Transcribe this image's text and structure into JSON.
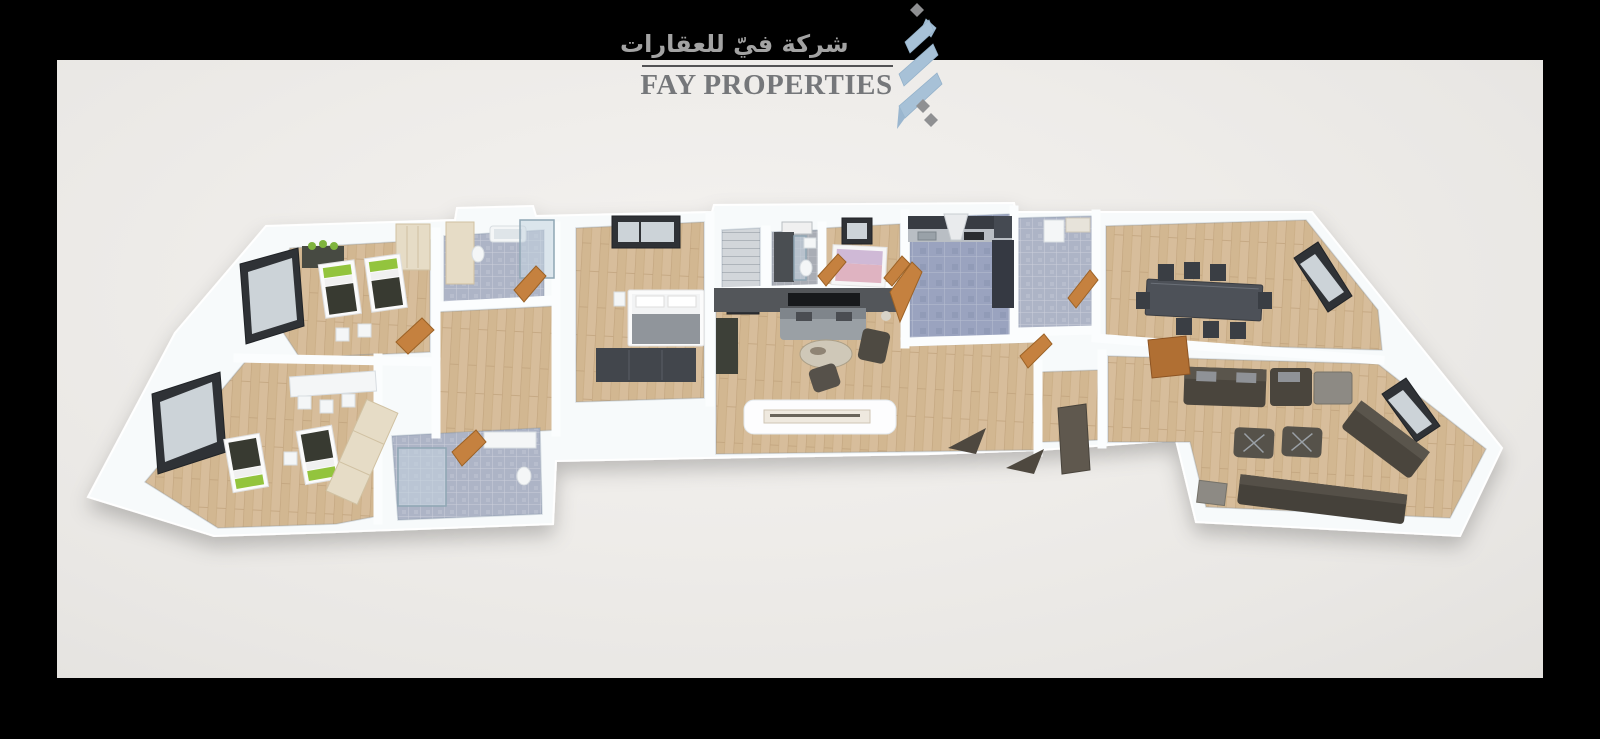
{
  "window": {
    "width": 1600,
    "height": 739
  },
  "brand": {
    "arabic_name": "شركة فيّ للعقارات",
    "english_name": "FAY PROPERTIES"
  },
  "logo": {
    "mark_name": "kufic-calligraphy-monogram",
    "mark_color": "#a7c1d7",
    "diamond_color": "#8f9092",
    "english_text_color": "#75777a",
    "arabic_text_color": "#a3a3a3",
    "divider_color": "#525254"
  },
  "scene": {
    "type": "3d-floorplan-render",
    "background_color": "#000000",
    "panel_color": "#efedea",
    "wall_color": "#f7fafb",
    "wood_floor_color": "#d7bd9b",
    "tile_floor_color": "#adb4c6",
    "kitchen_tile_color": "#9aa3bf",
    "door_color": "#c5813f",
    "furniture_dark_color": "#4b463e",
    "bed_accent_green": "#93c43d",
    "bed_accent_pink": "#dfb3c1",
    "entrance_arrow_color": "#4e483f"
  }
}
